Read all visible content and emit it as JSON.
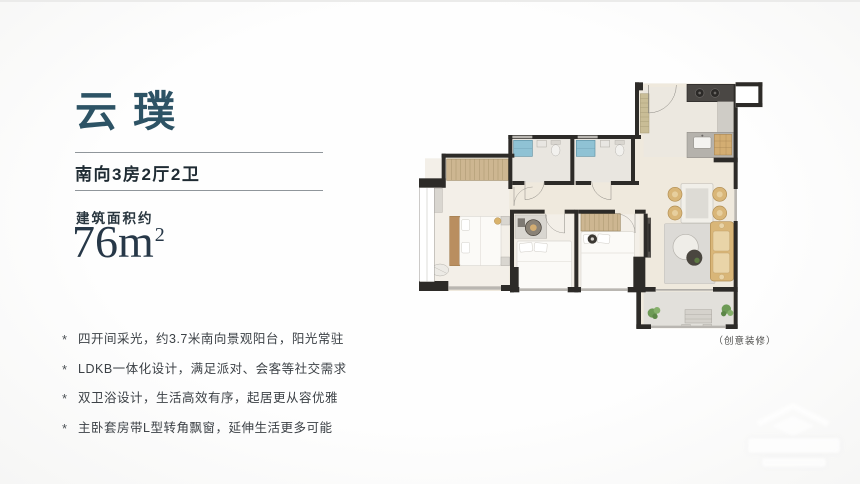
{
  "header": {
    "title": "云璞",
    "subtitle": "南向3房2厅2卫",
    "area_label": "建筑面积约",
    "area_number": "76",
    "area_unit": "m",
    "area_sup": "2"
  },
  "features": {
    "bullet_char": "*",
    "items": [
      "四开间采光，约3.7米南向景观阳台，阳光常驻",
      "LDKB一体化设计，满足派对、会客等社交需求",
      "双卫浴设计，生活高效有序，起居更从容优雅",
      "主卧套房带L型转角飘窗，延伸生活更多可能"
    ]
  },
  "floorplan": {
    "caption": "（创意装修）"
  },
  "colors": {
    "title_teal": "#2d5365",
    "text_dark": "#1f2b33",
    "wall_dark": "#2d2b28",
    "floor_cream": "#efe9dd",
    "shower_blue": "#8fc2d4",
    "wood_tan": "#d9b678",
    "plant_green": "#6d9a55"
  }
}
